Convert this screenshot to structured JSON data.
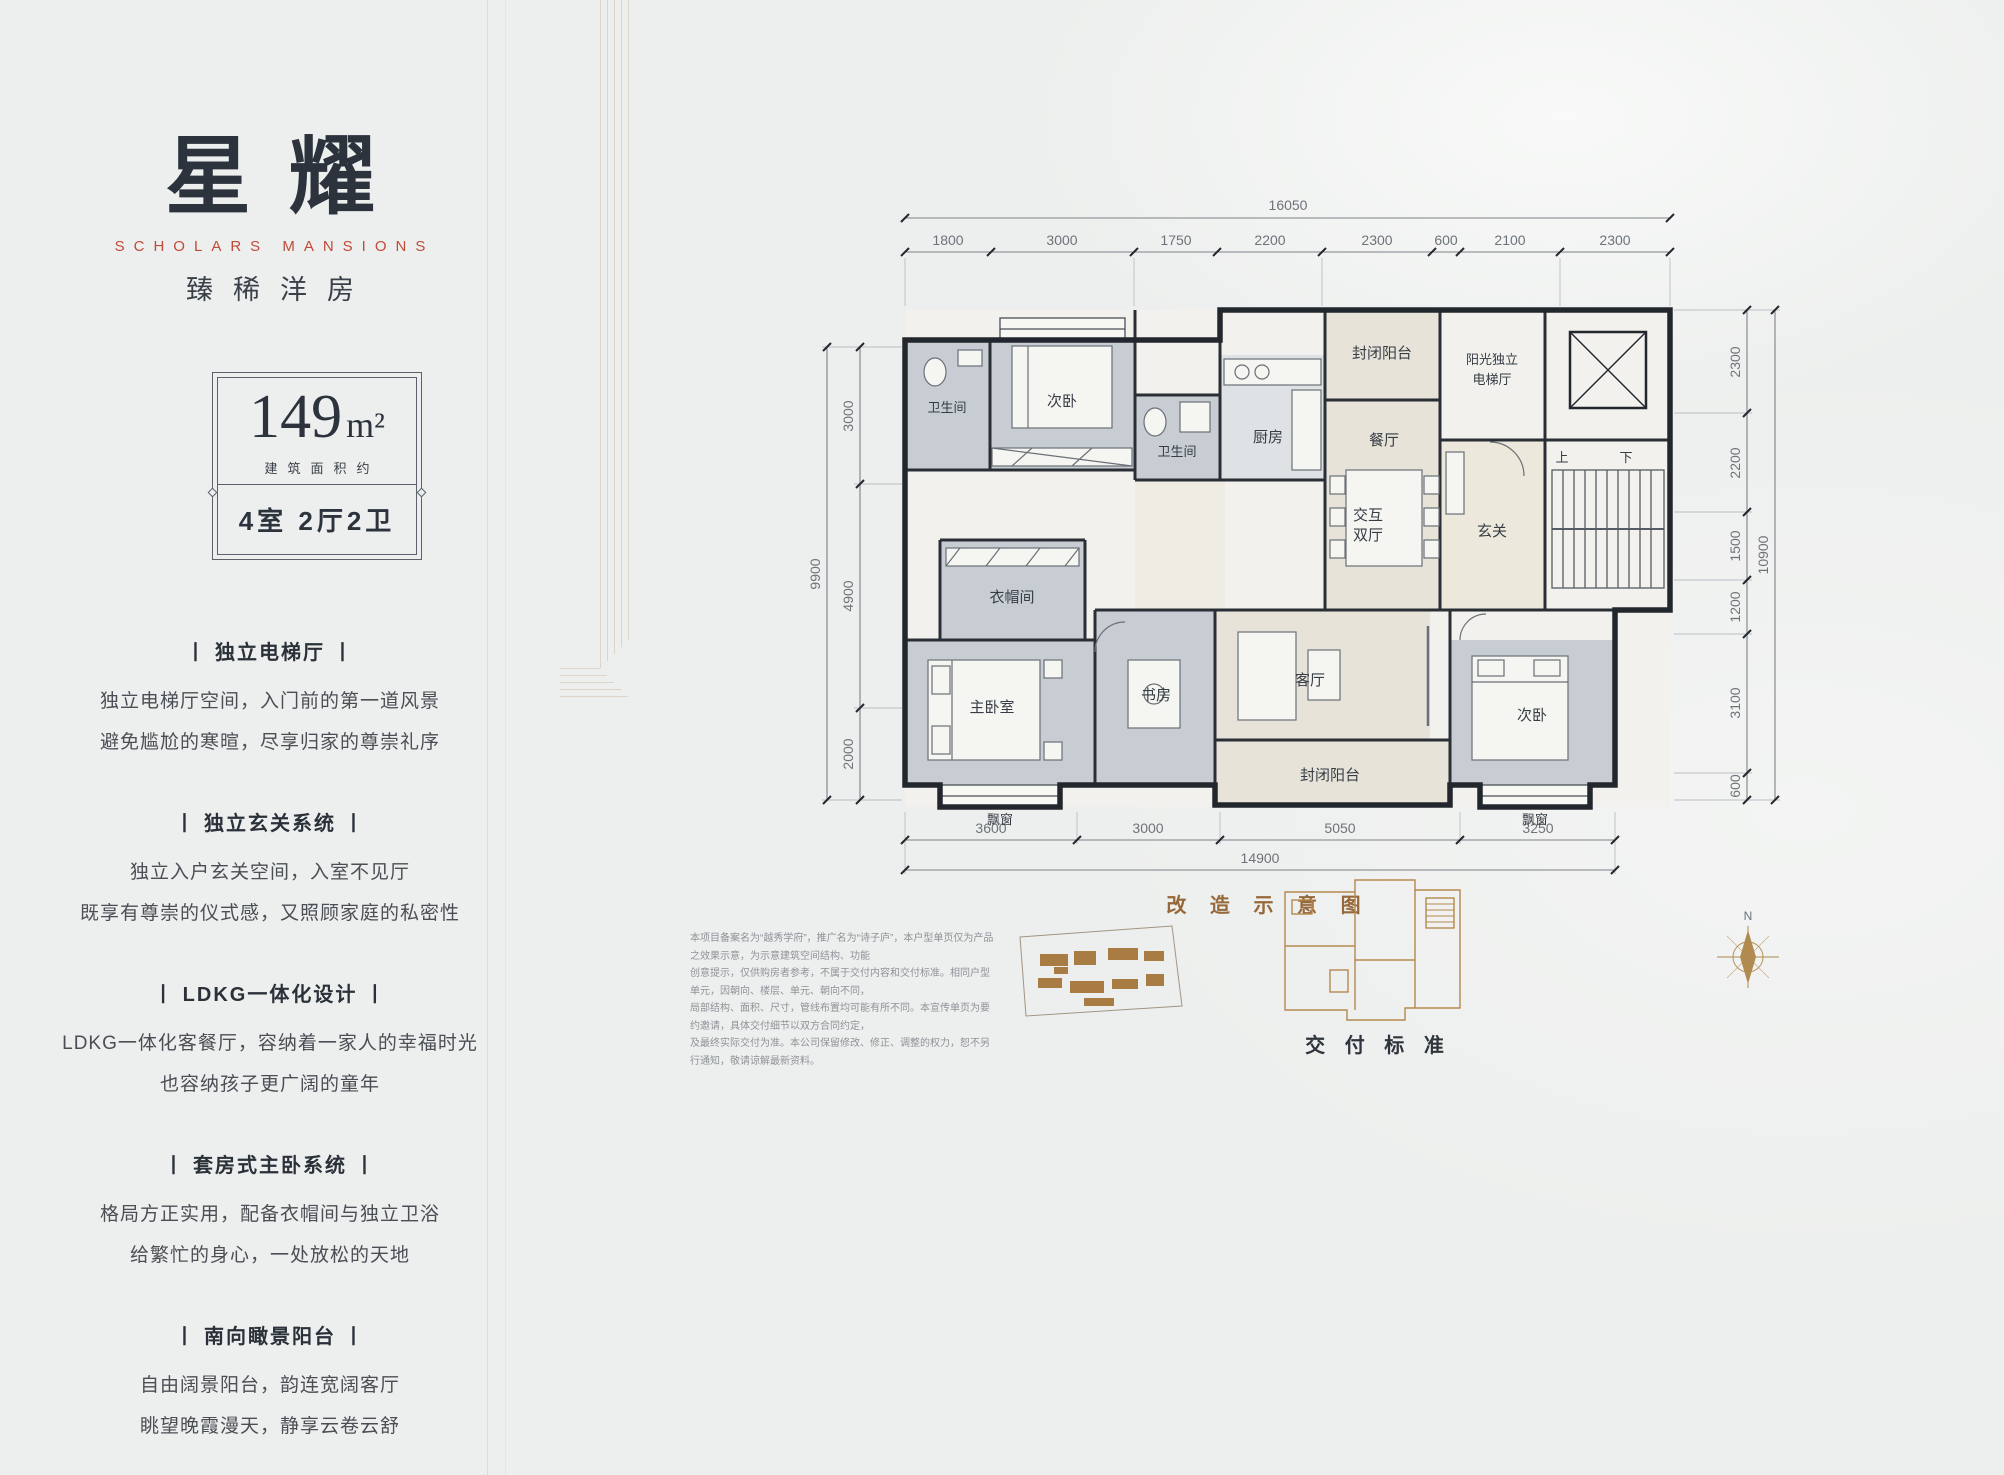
{
  "brand": {
    "title": "星耀",
    "subtitle": "SCHOLARS MANSIONS",
    "tagline": "臻稀洋房"
  },
  "spec": {
    "area_value": "149",
    "area_unit": "m²",
    "area_note": "建筑面积约",
    "layout": "4室 2厅2卫"
  },
  "features": [
    {
      "title": "丨 独立电梯厅 丨",
      "line1": "独立电梯厅空间，入门前的第一道风景",
      "line2": "避免尴尬的寒暄，尽享归家的尊崇礼序"
    },
    {
      "title": "丨 独立玄关系统 丨",
      "line1": "独立入户玄关空间，入室不见厅",
      "line2": "既享有尊崇的仪式感，又照顾家庭的私密性"
    },
    {
      "title": "丨 LDKG一体化设计 丨",
      "line1": "LDKG一体化客餐厅，容纳着一家人的幸福时光",
      "line2": "也容纳孩子更广阔的童年"
    },
    {
      "title": "丨 套房式主卧系统 丨",
      "line1": "格局方正实用，配备衣帽间与独立卫浴",
      "line2": "给繁忙的身心，一处放松的天地"
    },
    {
      "title": "丨 南向瞰景阳台 丨",
      "line1": "自由阔景阳台，韵连宽阔客厅",
      "line2": "眺望晚霞漫天，静享云卷云舒"
    }
  ],
  "plan": {
    "dims": {
      "top_total": "16050",
      "top_segments": [
        "1800",
        "3000",
        "1750",
        "2200",
        "2300",
        "600",
        "2100",
        "2300"
      ],
      "left_total": "9900",
      "left_segments": [
        "3000",
        "4900",
        "2000"
      ],
      "right_total": "10900",
      "right_segments": [
        "2300",
        "2200",
        "1500",
        "1200",
        "3100",
        "600"
      ],
      "bottom_total": "14900",
      "bottom_segments": [
        "3600",
        "3000",
        "5050",
        "3250"
      ]
    },
    "rooms": {
      "bath_top": "卫生间",
      "bedroom_top": "次卧",
      "bath_mid": "卫生间",
      "kitchen": "厨房",
      "balcony_top": "封闭阳台",
      "dining": "餐厅",
      "elevator_hall_line1": "阳光独立",
      "elevator_hall_line2": "电梯厅",
      "foyer": "玄关",
      "cloakroom": "衣帽间",
      "master": "主卧室",
      "study": "书房",
      "living": "客厅",
      "dual_hall_line1": "交互",
      "dual_hall_line2": "双厅",
      "balcony_bottom": "封闭阳台",
      "bedroom_bottom": "次卧",
      "bay_left": "飘窗",
      "bay_right": "飘窗",
      "stairs_up": "上",
      "stairs_down": "下"
    },
    "caption": "改 造 示 意 图",
    "compass_label": "N"
  },
  "footer": {
    "disclaimer_lines": [
      "本项目备案名为“越秀学府”，推广名为“诗子庐”，本户型单页仅为产品之效果示意，为示意建筑空间结构、功能",
      "创意提示，仅供购房者参考，不属于交付内容和交付标准。相同户型单元，因朝向、楼层、单元、朝向不同，",
      "局部结构、面积、尺寸，管线布置均可能有所不同。本宣传单页为要约邀请，具体交付细节以双方合同约定，",
      "及最终实际交付为准。本公司保留修改、修正、调整的权力，恕不另行通知，敬请谅解最新资料。"
    ],
    "delivery_label": "交 付 标 准"
  }
}
